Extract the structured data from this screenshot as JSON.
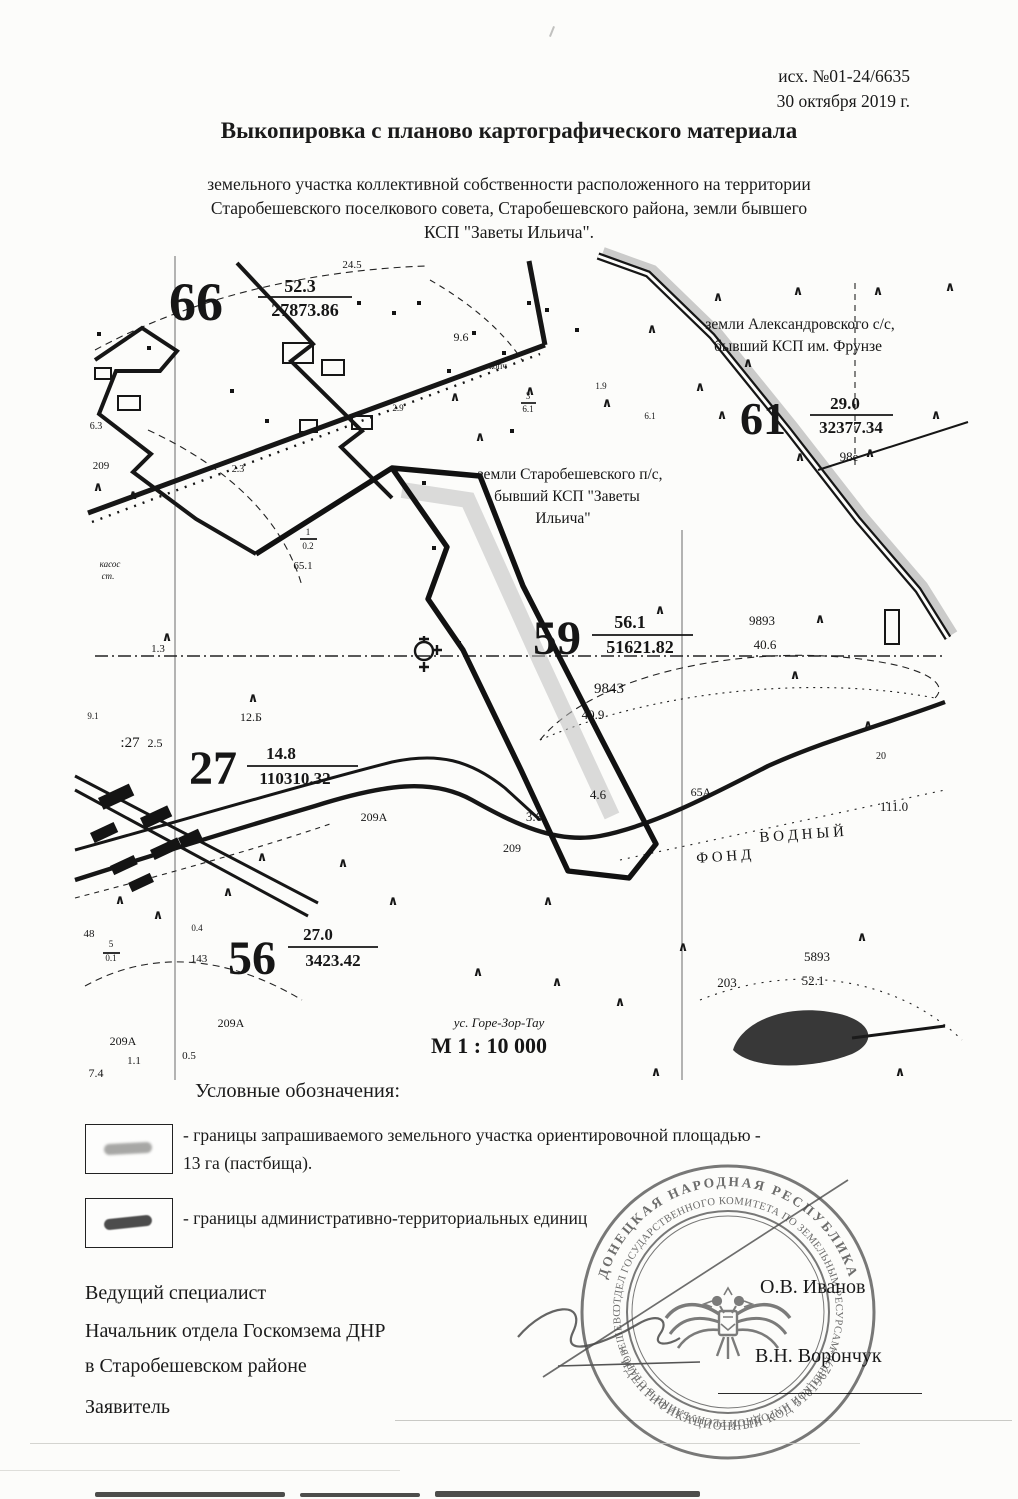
{
  "doc": {
    "ref_number": "исх. №01-24/6635",
    "ref_date": "30 октября 2019 г.",
    "title": "Выкопировка с планово картографического материала",
    "subtitle_lines": [
      "земельного участка коллективной собственности расположенного на территории",
      "Старобешевского поселкового совета, Старобешевского района, земли бывшего",
      "КСП \"Заветы Ильича\"."
    ]
  },
  "map": {
    "scale_label": "М 1 : 10 000",
    "region_labels": {
      "north_east": "земли Александровского с/с, бывший КСП им. Фрунзе",
      "center": "земли Старобешевского п/с, бывший КСП \"Заветы Ильича\"",
      "water": "ВОДНЫЙ ФОНД"
    },
    "labels": [
      {
        "t": "24.5",
        "x": 352,
        "y": 270,
        "s": 11
      },
      {
        "t": "66",
        "x": 196,
        "y": 322,
        "s": 54,
        "b": 1
      },
      {
        "t": "52.3",
        "x": 300,
        "y": 294,
        "s": 18,
        "b": 1
      },
      {
        "t": "27873.86",
        "x": 305,
        "y": 318,
        "s": 18,
        "b": 1
      },
      {
        "t": "земли Александровского с/с,",
        "x": 800,
        "y": 331,
        "s": 15.5
      },
      {
        "t": "бывший КСП им. Фрунзе",
        "x": 798,
        "y": 353,
        "s": 15.5
      },
      {
        "t": "61",
        "x": 763,
        "y": 436,
        "s": 46,
        "b": 1
      },
      {
        "t": "29.0",
        "x": 845,
        "y": 411,
        "s": 17,
        "b": 1
      },
      {
        "t": "32377.34",
        "x": 851,
        "y": 435,
        "s": 17,
        "b": 1
      },
      {
        "t": "98е",
        "x": 849,
        "y": 463,
        "s": 13
      },
      {
        "t": "9.6",
        "x": 461,
        "y": 343,
        "s": 12
      },
      {
        "t": "копч",
        "x": 498,
        "y": 371,
        "s": 9
      },
      {
        "t": "1.9",
        "x": 601,
        "y": 391,
        "s": 9
      },
      {
        "t": "6.1",
        "x": 650,
        "y": 421,
        "s": 9
      },
      {
        "t": "2.9",
        "x": 398,
        "y": 413,
        "s": 9
      },
      {
        "t": "3",
        "x": 528,
        "y": 401,
        "s": 9
      },
      {
        "t": "6.1",
        "x": 528,
        "y": 414,
        "s": 9
      },
      {
        "t": "земли Старобешевского п/с,",
        "x": 570,
        "y": 481,
        "s": 15.5
      },
      {
        "t": "бывший КСП \"Заветы",
        "x": 567,
        "y": 503,
        "s": 15.5
      },
      {
        "t": "Ильича\"",
        "x": 563,
        "y": 525,
        "s": 15.5
      },
      {
        "t": "209",
        "x": 101,
        "y": 471,
        "s": 11
      },
      {
        "t": "6.3",
        "x": 96,
        "y": 431,
        "s": 10
      },
      {
        "t": "2.3",
        "x": 238,
        "y": 474,
        "s": 10
      },
      {
        "t": "касос",
        "x": 110,
        "y": 569,
        "s": 9,
        "i": 1
      },
      {
        "t": "ст.",
        "x": 108,
        "y": 581,
        "s": 9,
        "i": 1
      },
      {
        "t": "65.1",
        "x": 303,
        "y": 571,
        "s": 11
      },
      {
        "t": "1",
        "x": 308,
        "y": 537,
        "s": 9
      },
      {
        "t": "0.2",
        "x": 308,
        "y": 551,
        "s": 9
      },
      {
        "t": "1.3",
        "x": 158,
        "y": 654,
        "s": 11
      },
      {
        "t": "59",
        "x": 557,
        "y": 656,
        "s": 48,
        "b": 1
      },
      {
        "t": "56.1",
        "x": 630,
        "y": 630,
        "s": 18,
        "b": 1
      },
      {
        "t": "51621.82",
        "x": 640,
        "y": 655,
        "s": 18,
        "b": 1
      },
      {
        "t": "9893",
        "x": 762,
        "y": 627,
        "s": 13
      },
      {
        "t": "40.6",
        "x": 765,
        "y": 651,
        "s": 13
      },
      {
        "t": "9843",
        "x": 609,
        "y": 695,
        "s": 15
      },
      {
        "t": "40.9",
        "x": 593,
        "y": 721,
        "s": 13
      },
      {
        "t": "12.Б",
        "x": 251,
        "y": 723,
        "s": 12
      },
      {
        "t": ":27",
        "x": 130,
        "y": 749,
        "s": 15
      },
      {
        "t": "2.5",
        "x": 155,
        "y": 749,
        "s": 12
      },
      {
        "t": "9.1",
        "x": 93,
        "y": 721,
        "s": 9
      },
      {
        "t": "27",
        "x": 213,
        "y": 786,
        "s": 48,
        "b": 1
      },
      {
        "t": "14.8",
        "x": 281,
        "y": 761,
        "s": 17,
        "b": 1
      },
      {
        "t": "110310.32",
        "x": 295,
        "y": 786,
        "s": 17,
        "b": 1
      },
      {
        "t": "209А",
        "x": 374,
        "y": 823,
        "s": 12
      },
      {
        "t": "209",
        "x": 512,
        "y": 854,
        "s": 12
      },
      {
        "t": "3.6",
        "x": 534,
        "y": 823,
        "s": 13
      },
      {
        "t": "4.6",
        "x": 598,
        "y": 801,
        "s": 13
      },
      {
        "t": "65А",
        "x": 701,
        "y": 798,
        "s": 12
      },
      {
        "t": "20",
        "x": 881,
        "y": 761,
        "s": 10
      },
      {
        "t": "111.0",
        "x": 894,
        "y": 813,
        "s": 13
      },
      {
        "t": "В О Д Н Ы Й",
        "x": 802,
        "y": 841,
        "s": 15,
        "r": -4
      },
      {
        "t": "Ф О Н Д",
        "x": 724,
        "y": 863,
        "s": 15,
        "r": -4
      },
      {
        "t": "5893",
        "x": 817,
        "y": 963,
        "s": 13
      },
      {
        "t": "52.1",
        "x": 813,
        "y": 987,
        "s": 13
      },
      {
        "t": "203",
        "x": 727,
        "y": 989,
        "s": 13
      },
      {
        "t": "48",
        "x": 89,
        "y": 939,
        "s": 11
      },
      {
        "t": "5",
        "x": 111,
        "y": 949,
        "s": 9
      },
      {
        "t": "0.1",
        "x": 111,
        "y": 963,
        "s": 9
      },
      {
        "t": "0.4",
        "x": 197,
        "y": 933,
        "s": 9
      },
      {
        "t": "143",
        "x": 199,
        "y": 964,
        "s": 11
      },
      {
        "t": "56",
        "x": 252,
        "y": 976,
        "s": 48,
        "b": 1
      },
      {
        "t": "27.0",
        "x": 318,
        "y": 942,
        "s": 17,
        "b": 1
      },
      {
        "t": "3423.42",
        "x": 333,
        "y": 968,
        "s": 17,
        "b": 1
      },
      {
        "t": "209А",
        "x": 231,
        "y": 1029,
        "s": 12
      },
      {
        "t": "209А",
        "x": 123,
        "y": 1047,
        "s": 12
      },
      {
        "t": "1.1",
        "x": 134,
        "y": 1066,
        "s": 11
      },
      {
        "t": "7.4",
        "x": 96,
        "y": 1079,
        "s": 12
      },
      {
        "t": "0.5",
        "x": 189,
        "y": 1061,
        "s": 11
      },
      {
        "t": "ус. Горе-Зор-Тау",
        "x": 499,
        "y": 1029,
        "s": 13,
        "i": 1
      },
      {
        "t": "М 1 : 10 000",
        "x": 489,
        "y": 1055,
        "s": 22,
        "b": 1
      }
    ],
    "fraction_bars": [
      [
        258,
        299,
        352,
        299
      ],
      [
        810,
        417,
        893,
        417
      ],
      [
        592,
        637,
        693,
        637
      ],
      [
        247,
        768,
        358,
        768
      ],
      [
        288,
        949,
        378,
        949
      ],
      [
        300,
        541,
        317,
        541
      ],
      [
        521,
        405,
        536,
        405
      ],
      [
        103,
        955,
        120,
        955
      ]
    ],
    "carets": [
      [
        718,
        303
      ],
      [
        798,
        297
      ],
      [
        878,
        297
      ],
      [
        950,
        293
      ],
      [
        748,
        369
      ],
      [
        652,
        335
      ],
      [
        700,
        393
      ],
      [
        722,
        421
      ],
      [
        936,
        421
      ],
      [
        870,
        459
      ],
      [
        800,
        463
      ],
      [
        455,
        403
      ],
      [
        530,
        397
      ],
      [
        607,
        409
      ],
      [
        480,
        443
      ],
      [
        98,
        493
      ],
      [
        133,
        501
      ],
      [
        167,
        643
      ],
      [
        253,
        704
      ],
      [
        343,
        869
      ],
      [
        393,
        907
      ],
      [
        548,
        907
      ],
      [
        478,
        978
      ],
      [
        557,
        988
      ],
      [
        620,
        1008
      ],
      [
        683,
        953
      ],
      [
        862,
        943
      ],
      [
        900,
        1078
      ],
      [
        228,
        898
      ],
      [
        262,
        863
      ],
      [
        158,
        921
      ],
      [
        656,
        1078
      ],
      [
        868,
        731
      ],
      [
        795,
        681
      ],
      [
        120,
        906
      ],
      [
        660,
        616
      ],
      [
        820,
        625
      ]
    ],
    "squares": [
      [
        472,
        333
      ],
      [
        502,
        353
      ],
      [
        447,
        371
      ],
      [
        417,
        303
      ],
      [
        527,
        303
      ],
      [
        392,
        313
      ],
      [
        357,
        303
      ],
      [
        147,
        348
      ],
      [
        422,
        483
      ],
      [
        432,
        548
      ],
      [
        457,
        643
      ],
      [
        97,
        334
      ],
      [
        265,
        421
      ],
      [
        230,
        391
      ],
      [
        510,
        431
      ],
      [
        545,
        310
      ],
      [
        575,
        330
      ]
    ],
    "buildings": [
      [
        283,
        345,
        30,
        20
      ],
      [
        322,
        362,
        22,
        15
      ],
      [
        300,
        422,
        17,
        12
      ],
      [
        352,
        418,
        20,
        13
      ],
      [
        118,
        398,
        22,
        14
      ],
      [
        95,
        370,
        16,
        11
      ],
      [
        885,
        612,
        14,
        34
      ]
    ],
    "village_blocks": [
      [
        98,
        800,
        34,
        13
      ],
      [
        140,
        820,
        30,
        12
      ],
      [
        90,
        835,
        26,
        11
      ],
      [
        150,
        852,
        30,
        11
      ],
      [
        110,
        868,
        26,
        10
      ],
      [
        178,
        840,
        22,
        10
      ],
      [
        128,
        885,
        24,
        10
      ]
    ]
  },
  "legend": {
    "header": "Условные обозначения:",
    "item1_line1": "- границы запрашиваемого земельного участка ориентировочной площадью -",
    "item1_line2": "13 га (пастбища).",
    "item2_line1": "- границы административно-территориальных единиц"
  },
  "signatures": {
    "row1_role": "Ведущий специалист",
    "row1_name": "О.В. Иванов",
    "row2_role_line1": "Начальник отдела Госкомзема ДНР",
    "row2_role_line2": "в Старобешевском районе",
    "row2_name": "В.Н. Ворончук",
    "row3_role": "Заявитель"
  },
  "stamp": {
    "ring_outer_top": "ДОНЕЦКАЯ НАРОДНАЯ РЕСПУБЛИКА",
    "ring_outer_bottom": "* ИДЕНТИФИКАЦИОННЫЙ КОД 51019627 *",
    "ring_inner": "ОТДЕЛ ГОСУДАРСТВЕННОГО КОМИТЕТА ПО ЗЕМЕЛЬНЫМ РЕСУРСАМ ДОНЕЦКОЙ НАРОДНОЙ РЕСПУБЛИКИ В СТАРОБЕШЕВСКОМ РАЙОНЕ *",
    "color": "#6e6e6e"
  },
  "colors": {
    "paper": "#fcfcfa",
    "ink": "#1a1a1a",
    "map_ink": "#161616",
    "highlight": "#bdbdbd",
    "stamp": "#6e6e6e"
  }
}
